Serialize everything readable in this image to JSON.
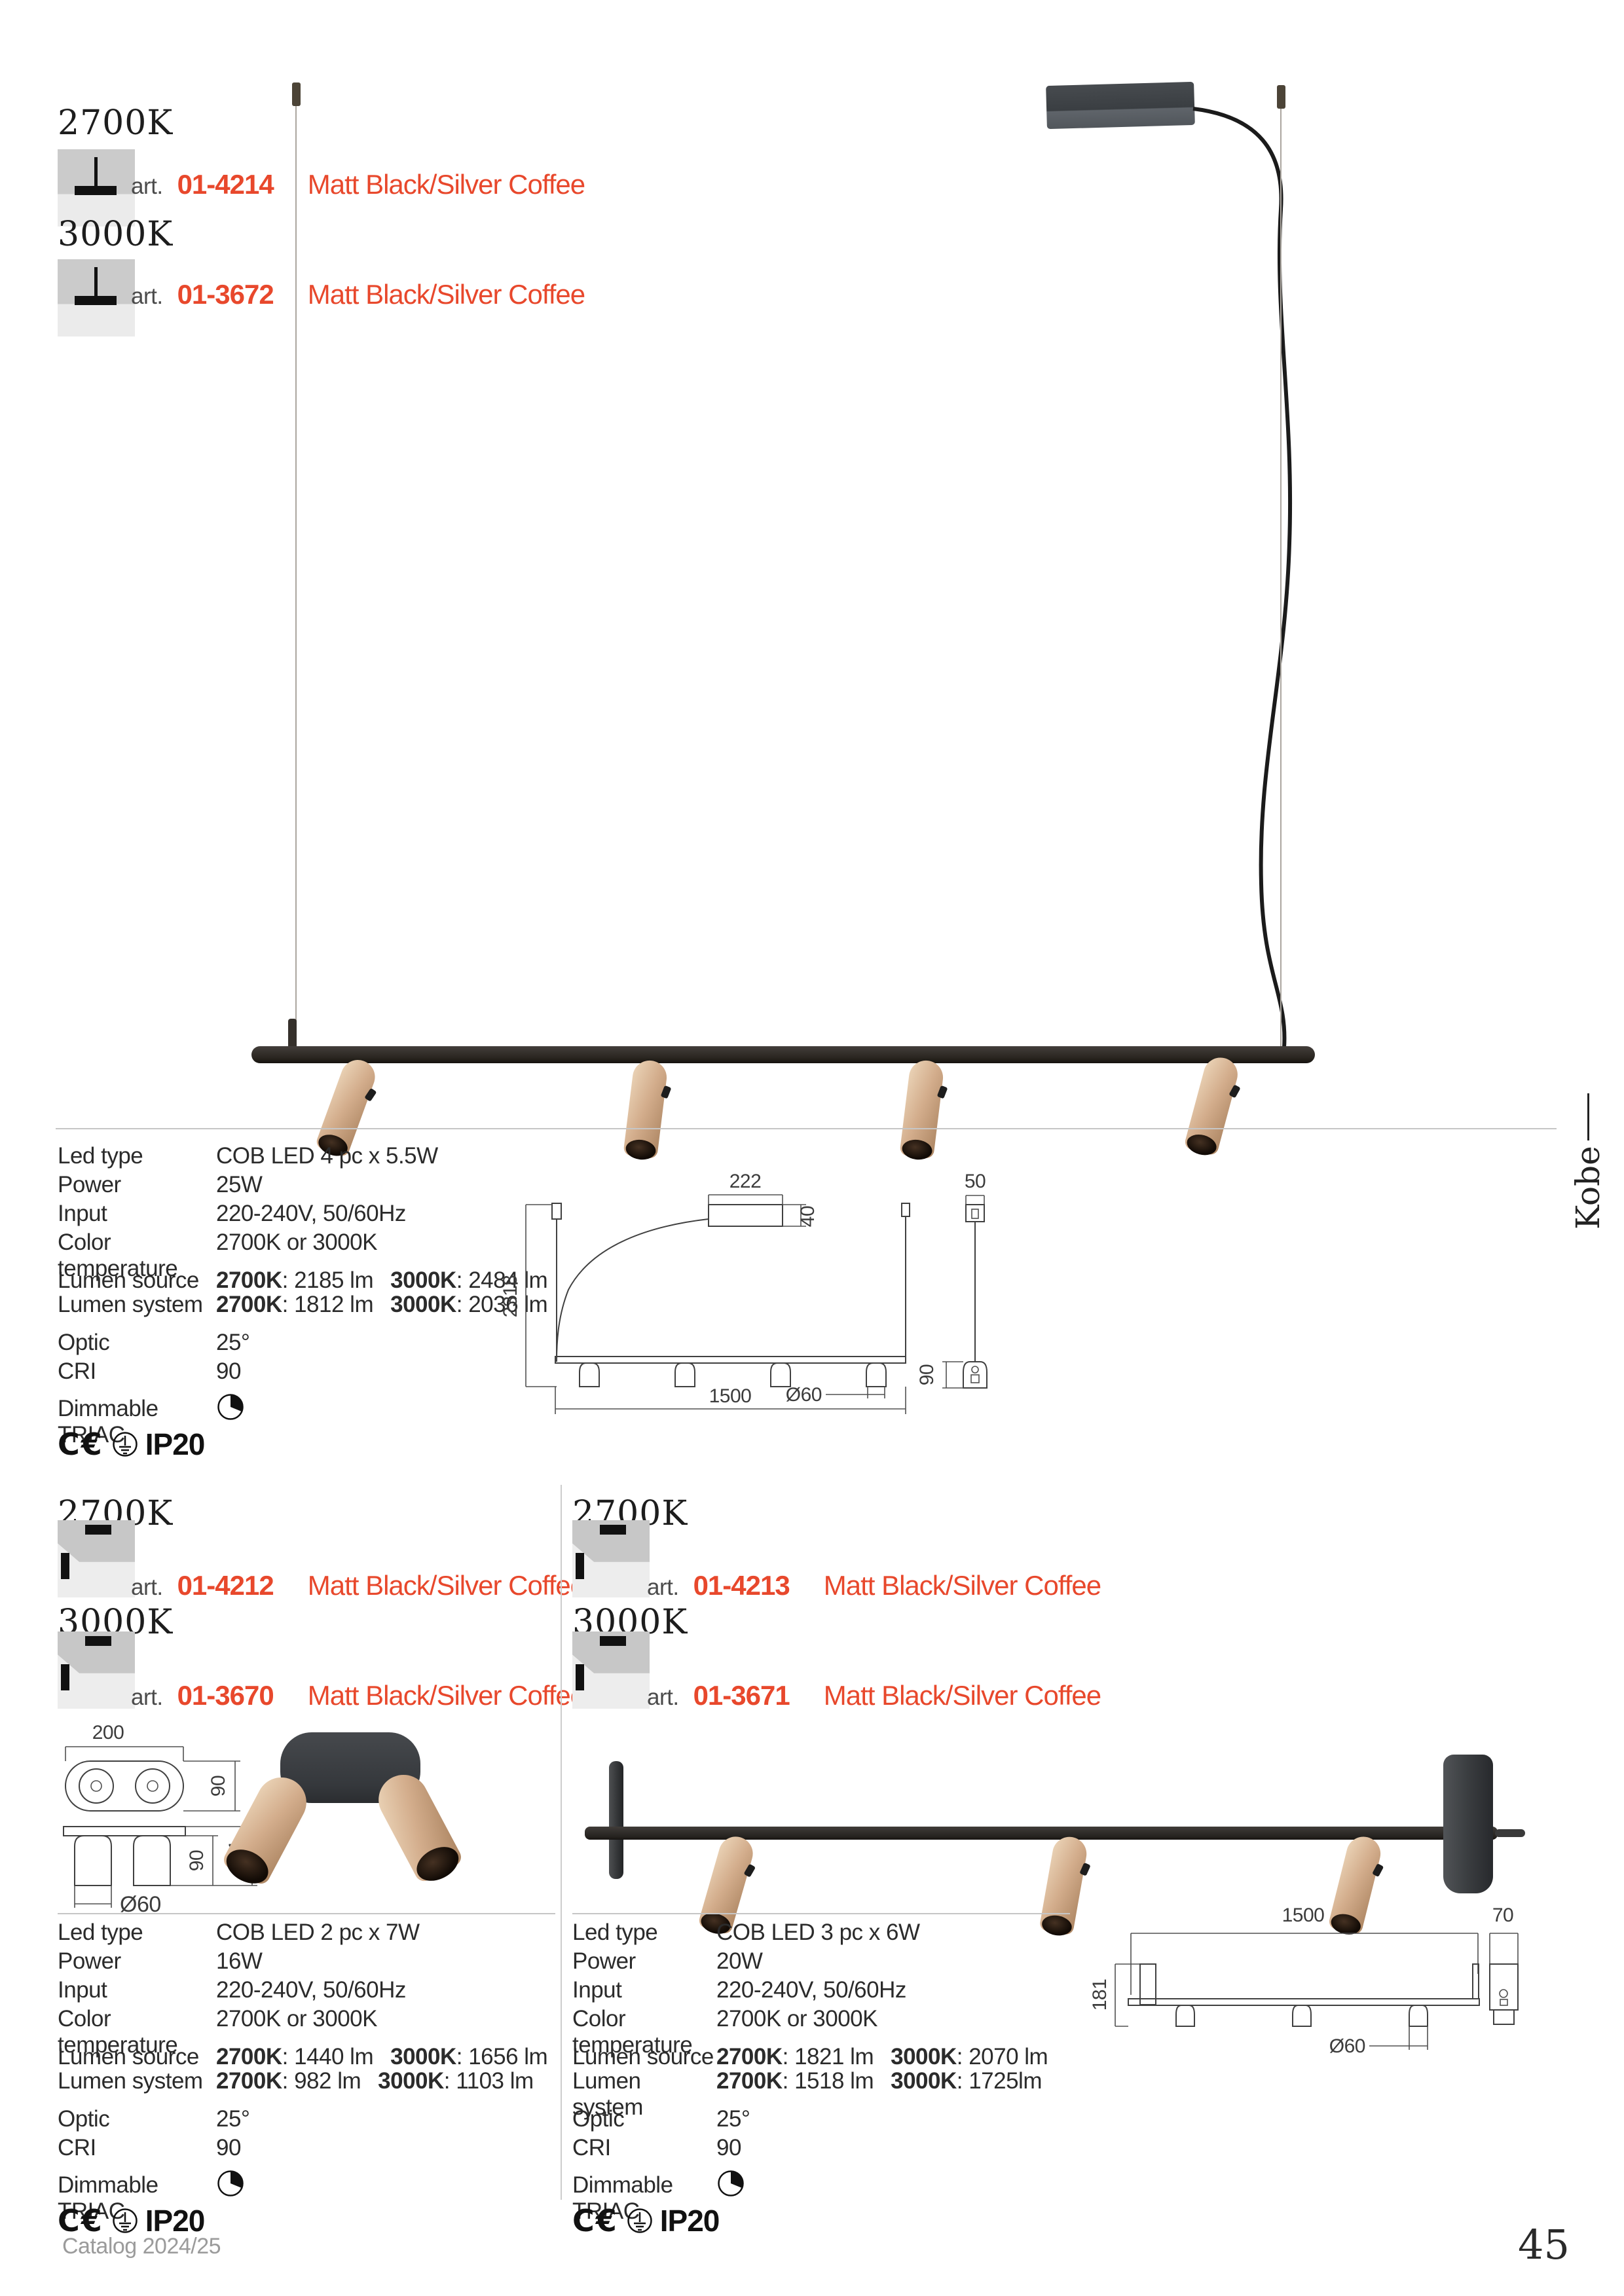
{
  "family": "Kobe",
  "art_label": "art.",
  "finish": "Matt Black/Silver Coffee",
  "accent": "#e8482c",
  "footer": {
    "catalog": "Catalog 2024/25",
    "page": "45"
  },
  "labels": {
    "led": "Led type",
    "power": "Power",
    "input": "Input",
    "ct": "Color temperature",
    "lsrc": "Lumen source",
    "lsys": "Lumen system",
    "optic": "Optic",
    "cri": "CRI",
    "dim": "Dimmable  TRIAC",
    "ce": "C€",
    "ip": "IP20"
  },
  "top": {
    "variants": [
      {
        "temp": "2700K",
        "code": "01-4214"
      },
      {
        "temp": "3000K",
        "code": "01-3672"
      }
    ],
    "specs": {
      "led": "COB LED  4 pc x 5.5W",
      "power": "25W",
      "input": "220-240V, 50/60Hz",
      "ct": "2700K or 3000K",
      "lsrc": {
        "k1": "2700K",
        "v1": ": 2185 lm",
        "k2": "3000K",
        "v2": ": 2484 lm"
      },
      "lsys": {
        "k1": "2700K",
        "v1": ": 1812 lm",
        "k2": "3000K",
        "v2": ": 2036 lm"
      },
      "optic": "25°",
      "cri": "90"
    },
    "dims": {
      "canopy_w": "222",
      "canopy_h": "40",
      "drop": "2318",
      "length": "1500",
      "diameter": "Ø60",
      "side_w": "50",
      "spot_h": "90"
    }
  },
  "bottom_left": {
    "variants": [
      {
        "temp": "2700K",
        "code": "01-4212"
      },
      {
        "temp": "3000K",
        "code": "01-3670"
      }
    ],
    "specs": {
      "led": "COB LED  2 pc x 7W",
      "power": "16W",
      "input": "220-240V, 50/60Hz",
      "ct": "2700K or 3000K",
      "lsrc": {
        "k1": "2700K",
        "v1": ": 1440 lm",
        "k2": "3000K",
        "v2": ": 1656 lm"
      },
      "lsys": {
        "k1": "2700K",
        "v1": ": 982 lm",
        "k2": "3000K",
        "v2": ": 1103 lm"
      },
      "optic": "25°",
      "cri": "90"
    },
    "dims": {
      "width": "200",
      "depth": "90",
      "spot_h": "90",
      "total_h": "121",
      "diameter": "Ø60"
    }
  },
  "bottom_right": {
    "variants": [
      {
        "temp": "2700K",
        "code": "01-4213"
      },
      {
        "temp": "3000K",
        "code": "01-3671"
      }
    ],
    "specs": {
      "led": "COB LED  3 pc x 6W",
      "power": "20W",
      "input": "220-240V, 50/60Hz",
      "ct": "2700K or 3000K",
      "lsrc": {
        "k1": "2700K",
        "v1": ": 1821 lm",
        "k2": "3000K",
        "v2": ": 2070 lm"
      },
      "lsys": {
        "k1": "2700K",
        "v1": ": 1518 lm",
        "k2": "3000K",
        "v2": ": 1725lm"
      },
      "optic": "25°",
      "cri": "90"
    },
    "dims": {
      "length": "1500",
      "side_w": "70",
      "total_h": "181",
      "diameter": "Ø60"
    }
  }
}
